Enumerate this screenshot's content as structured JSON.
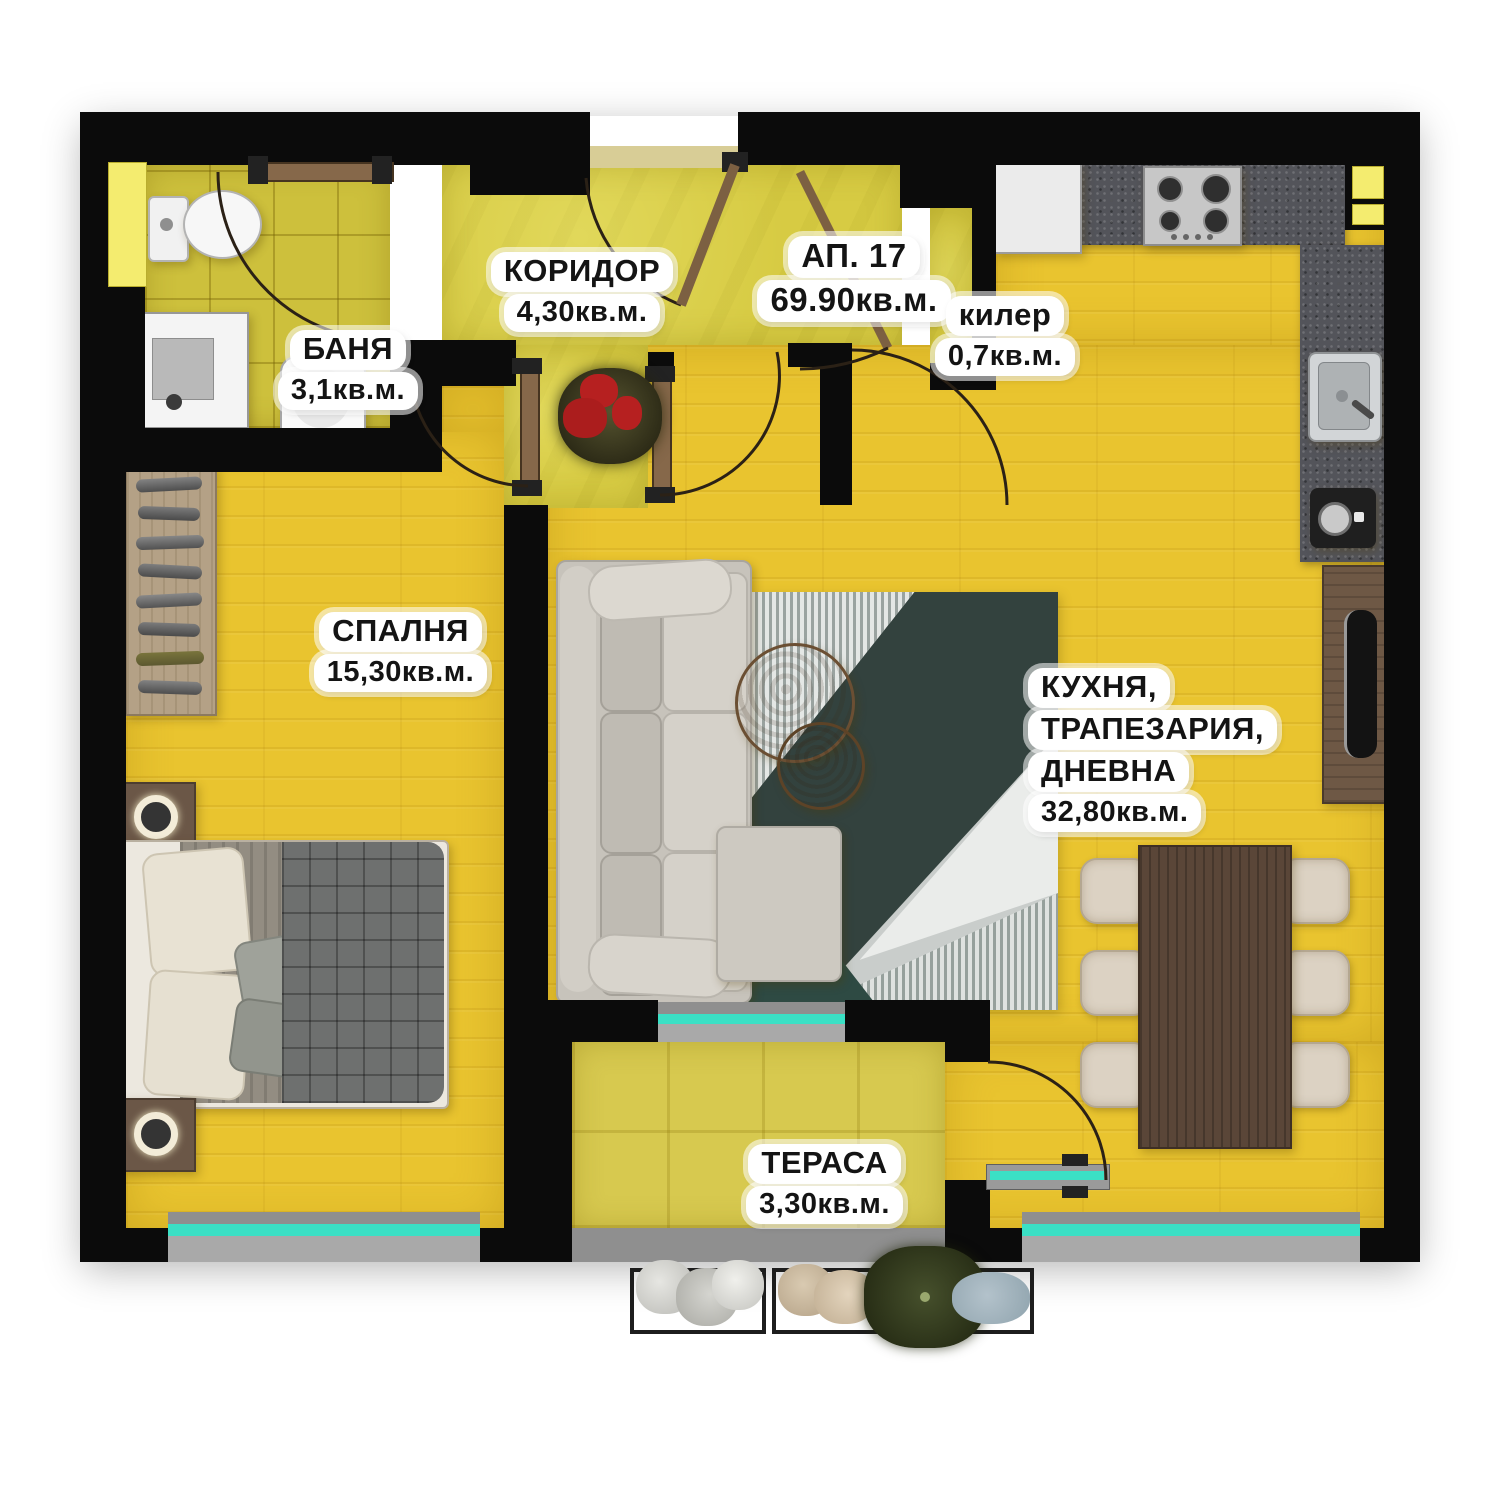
{
  "apartment": {
    "label": "АП. 17",
    "area": "69.90кв.м."
  },
  "rooms": [
    {
      "id": "corridor",
      "name": "КОРИДОР",
      "area": "4,30кв.м."
    },
    {
      "id": "bathroom",
      "name": "БАНЯ",
      "area": "3,1кв.м."
    },
    {
      "id": "pantry",
      "name": "килер",
      "area": "0,7кв.м."
    },
    {
      "id": "bedroom",
      "name": "СПАЛНЯ",
      "area": "15,30кв.м."
    },
    {
      "id": "kitchen-dining-living",
      "name_lines": [
        "КУХНЯ,",
        "ТРАПЕЗАРИЯ,",
        "ДНЕВНА"
      ],
      "area": "32,80кв.м."
    },
    {
      "id": "terrace",
      "name": "ТЕРАСА",
      "area": "3,30кв.м."
    }
  ],
  "colors": {
    "wall": "#0b0b0b",
    "floor_wood": "#e9c42f",
    "floor_corridor": "#d7cb43",
    "floor_bath_tile": "#cdc03c",
    "floor_terrace": "#d7c94f",
    "counter": "#53545a",
    "window_glass_teal": "#3be0c5",
    "window_sill_gray": "#8f8f8f",
    "window_yellow": "#f4ec6f",
    "label_bg": "#ffffff",
    "label_text": "#141414"
  },
  "furniture_icons": [
    "toilet-icon",
    "shower-icon",
    "washbasin-icon",
    "wardrobe-icon",
    "double-bed-icon",
    "nightstand-lamp-icon",
    "sofa-icon",
    "area-rug-icon",
    "coffee-table-icon",
    "dining-table-icon",
    "dining-chair-icon",
    "fridge-icon",
    "gas-stove-icon",
    "kitchen-sink-icon",
    "coffee-machine-icon",
    "tv-stand-icon",
    "flower-pot-icon",
    "window-plants-icon"
  ]
}
